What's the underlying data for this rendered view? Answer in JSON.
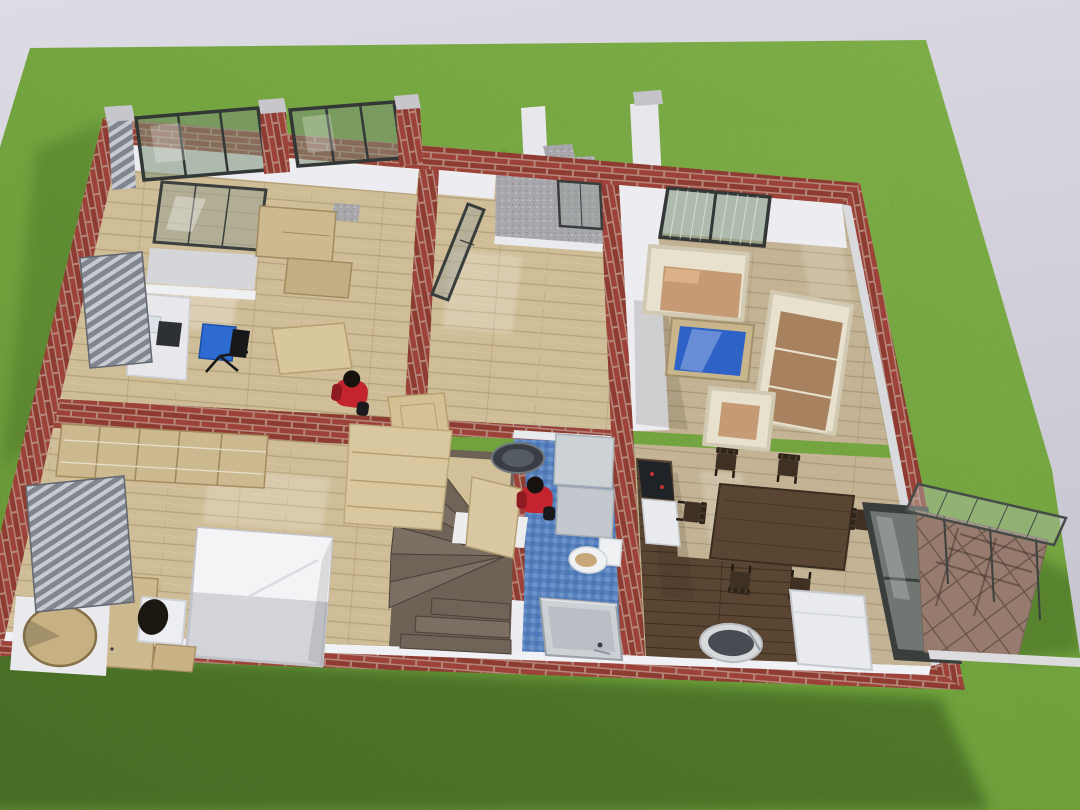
{
  "scene": {
    "type": "3d-architectural-render",
    "view": "isometric top-down cutaway (dollhouse) of a single-storey house standing on a large lawn",
    "environment": {
      "sky": "pale lavender-grey gradient backdrop",
      "ground": "large rectangular green lawn with mowed grass texture",
      "lighting": "sun from upper right; house shadow falls to lower left"
    }
  },
  "house": {
    "construction": "red clay brick walls shown cut from above, white plastered inner faces, light timber floors",
    "rooms": [
      {
        "id": "bedroom-office",
        "label": "Office bedroom (top left)",
        "floor": "light wood planks",
        "contents": [
          "tilted balcony glazing",
          "grey balcony deck",
          "timber wardrobe cabinets",
          "granite block",
          "white desk with laptop and dark keyboard",
          "blue swivel office chair",
          "louvred shutters"
        ]
      },
      {
        "id": "hallway",
        "label": "Entrance hall (centre)",
        "floor": "light wood planks",
        "contents": [
          "granite entry landing",
          "glazed entry door standing open",
          "two unhung light timber doors",
          "standing person in red shirt"
        ]
      },
      {
        "id": "bedroom-2",
        "label": "Bedroom (bottom left)",
        "floor": "light wood planks",
        "contents": [
          "open wardrobe shelving row",
          "double bed with white duvet",
          "timber desk",
          "white chair with seated dark-haired person",
          "timber stool",
          "round timber table on white deck",
          "louvred shutters"
        ]
      },
      {
        "id": "staircase",
        "label": "Winder staircase (centre bottom)",
        "floor": "dark grey-brown treads",
        "contents": [
          "light timber upper flight (cut)",
          "white parapet",
          "fanned winder treads"
        ]
      },
      {
        "id": "bathroom",
        "label": "Bathroom (centre)",
        "floor": "blue mosaic tile",
        "contents": [
          "round ceiling lamp",
          "two grey cabinets",
          "toilet with timber seat",
          "grey shower tray",
          "open timber door",
          "standing person in red shirt"
        ]
      },
      {
        "id": "living-room",
        "label": "Living room (top right)",
        "floor": "grey-washed wood planks",
        "contents": [
          "ribbed roof glazing band",
          "cream two-seat sofa with tan cushions",
          "cream three-seat sofa with tan cushions",
          "cream armchair",
          "coffee table with blue glass top"
        ]
      },
      {
        "id": "kitchen-dining",
        "label": "Kitchen and dining (bottom right)",
        "floor": "light wood with dark walnut strip",
        "contents": [
          "black cooktop",
          "white counter",
          "dark walnut dining table",
          "six dark dining chairs",
          "spare chair by wall",
          "oval basin",
          "white fridge cabinet",
          "tall glazed door to terrace"
        ]
      }
    ],
    "exterior": [
      {
        "id": "entry-steps",
        "label": "Sunken entry: granite garden steps between white parapet walls"
      },
      {
        "id": "roof-glazing",
        "label": "Tilted skylight bands between brick piers along the top facade"
      },
      {
        "id": "gravel-strip",
        "label": "Grey gravel strip along the rear wall"
      },
      {
        "id": "terrace",
        "label": "Paved terrace with glass canopy on slim posts (right side)"
      },
      {
        "id": "louvres",
        "label": "Grey louvred shutters on the left facade"
      }
    ],
    "people": [
      {
        "id": "person-hall",
        "desc": "figure in red shirt with black hair standing in the hallway"
      },
      {
        "id": "person-bathroom",
        "desc": "figure in red shirt with black hair standing in the bathroom"
      },
      {
        "id": "person-desk",
        "desc": "dark-haired figure seated on a white chair at the bedroom desk"
      }
    ],
    "counts": {
      "rooms": 7,
      "people": 3,
      "dining_chairs": 7,
      "sofas": 3,
      "louvre_panels": 4
    }
  },
  "palette": {
    "sky_top": "#dddbe4",
    "sky_bot": "#c6c4cf",
    "grass": "#6ba135",
    "grass_hi": "#7cb044",
    "grass_sh": "#1e3a0c",
    "brick": "#9c4238",
    "brick2": "#8e3c31",
    "mortar": "#b5867a",
    "wall": "#ececf1",
    "wall_shade": "#d7d8de",
    "wood_light": "#cfbd97",
    "wood_grey": "#c3b394",
    "wood_dark": "#5a4533",
    "wood_furn": "#cdb98f",
    "wood_door": "#d8c69d",
    "glass_frame": "#3a3f3d",
    "blue_tile": "#5881bd",
    "blue_table": "#2e62c6",
    "stair": "#6e6156",
    "paver": "#977b6e",
    "louver_hi": "#c7cad1",
    "louver_lo": "#80858f",
    "cream": "#e7e1ce",
    "tan": "#c59a74",
    "tan_dark": "#a8825f",
    "cab_grey": "#cbd0d5",
    "red_shirt": "#c3242e",
    "granite": "#a7a7ac",
    "concrete": "#e8e8ec"
  }
}
